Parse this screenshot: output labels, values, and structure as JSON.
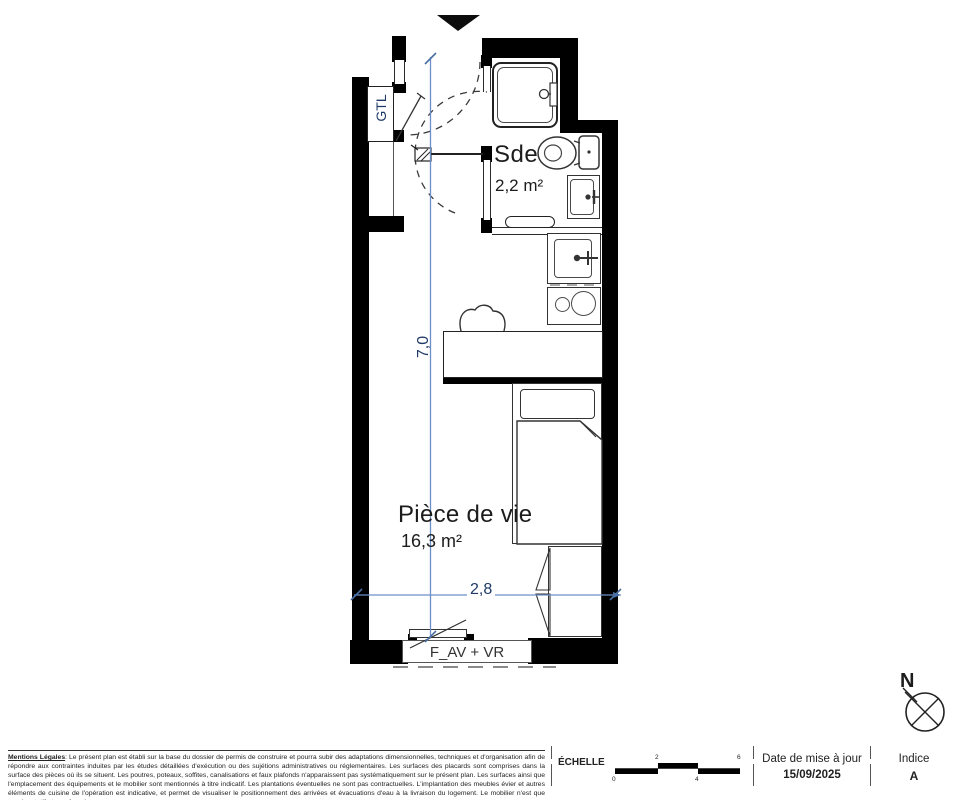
{
  "plan": {
    "rooms": [
      {
        "name": "Sde",
        "area": "2,2 m²"
      },
      {
        "name": "Pièce de vie",
        "area": "16,3 m²"
      }
    ],
    "labels": {
      "gtl": "GTL",
      "window": "F_AV + VR"
    },
    "dimensions": {
      "vertical": "7,0",
      "horizontal": "2,8"
    },
    "compass": {
      "north": "N"
    },
    "colors": {
      "wall": "#000000",
      "dimension_line": "#6d8fc9",
      "dimension_text": "#1f3a67"
    }
  },
  "footer": {
    "legal": {
      "label": "Mentions Légales",
      "text": ": Le présent plan est établi sur la base du dossier de permis de construire et pourra subir des adaptations dimensionnelles, techniques et d'organisation afin de répondre aux contraintes induites par les études détaillées d'exécution ou des sujétions administratives ou réglementaires. Les surfaces des placards sont comprises dans la surface des pièces où ils se situent. Les poutres, poteaux, soffites, canalisations et faux plafonds n'apparaissent pas systématiquement sur le présent plan. Les surfaces ainsi que l'emplacement des équipements et le mobilier sont mentionnés à titre indicatif. Les plantations éventuelles ne sont pas contractuelles. L'implantation des meubles évier et autres éléments de cuisine de l'opération est indicative, et permet de visualiser le positionnement des arrivées et évacuations d'eau à la livraison du logement. Le mobilier n'est que représentatif et non-fourni."
    },
    "scale": {
      "label": "ÉCHELLE",
      "ticks": [
        "0",
        "2",
        "4",
        "6"
      ]
    },
    "date": {
      "label": "Date de mise à jour",
      "value": "15/09/2025"
    },
    "index": {
      "label": "Indice",
      "value": "A"
    }
  }
}
